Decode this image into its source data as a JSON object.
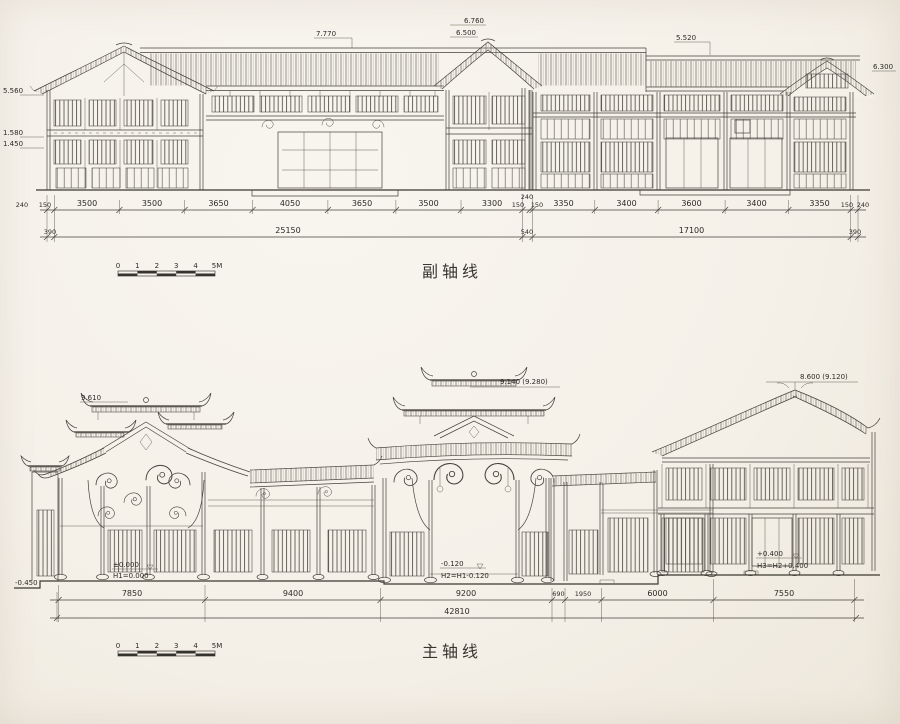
{
  "colors": {
    "paper": "#f5f1e9",
    "ink": "#45423c",
    "text": "#2c2a26"
  },
  "top": {
    "label": "副轴线",
    "marks": {
      "left_a": "5.560",
      "left_b": "1.580",
      "left_c": "1.450",
      "ridge_main": "7.770",
      "gable_mid_a": "6.760",
      "gable_mid_b": "6.500",
      "ridge_right": "5.520",
      "eave_right": "6.300"
    },
    "dims": {
      "r1": [
        "240",
        "150",
        "3500",
        "3500",
        "3650",
        "4050",
        "3650",
        "3500",
        "3300",
        "150",
        "240",
        "150",
        "3350",
        "3400",
        "3600",
        "3400",
        "3350",
        "150",
        "240"
      ],
      "r2": [
        "390",
        "25150",
        "540",
        "17100",
        "390"
      ]
    },
    "scale": [
      "0",
      "1",
      "2",
      "3",
      "4",
      "5M"
    ]
  },
  "bottom": {
    "label": "主轴线",
    "marks": {
      "left_gable": "9.610",
      "center_gable": "9.140 (9.280)",
      "right_gable": "8.600 (9.120)",
      "ground_outer": "-0.450",
      "g1": "±0.000",
      "g1n": "H1=0.000",
      "g2": "-0.120",
      "g2n": "H2=H1-0.120",
      "g3": "+0.400",
      "g3n": "H3=H2+0.400"
    },
    "dims": {
      "r1": [
        "7850",
        "9400",
        "9200",
        "690",
        "1950",
        "6000",
        "7550"
      ],
      "total": "42810"
    },
    "scale": [
      "0",
      "1",
      "2",
      "3",
      "4",
      "5M"
    ]
  }
}
